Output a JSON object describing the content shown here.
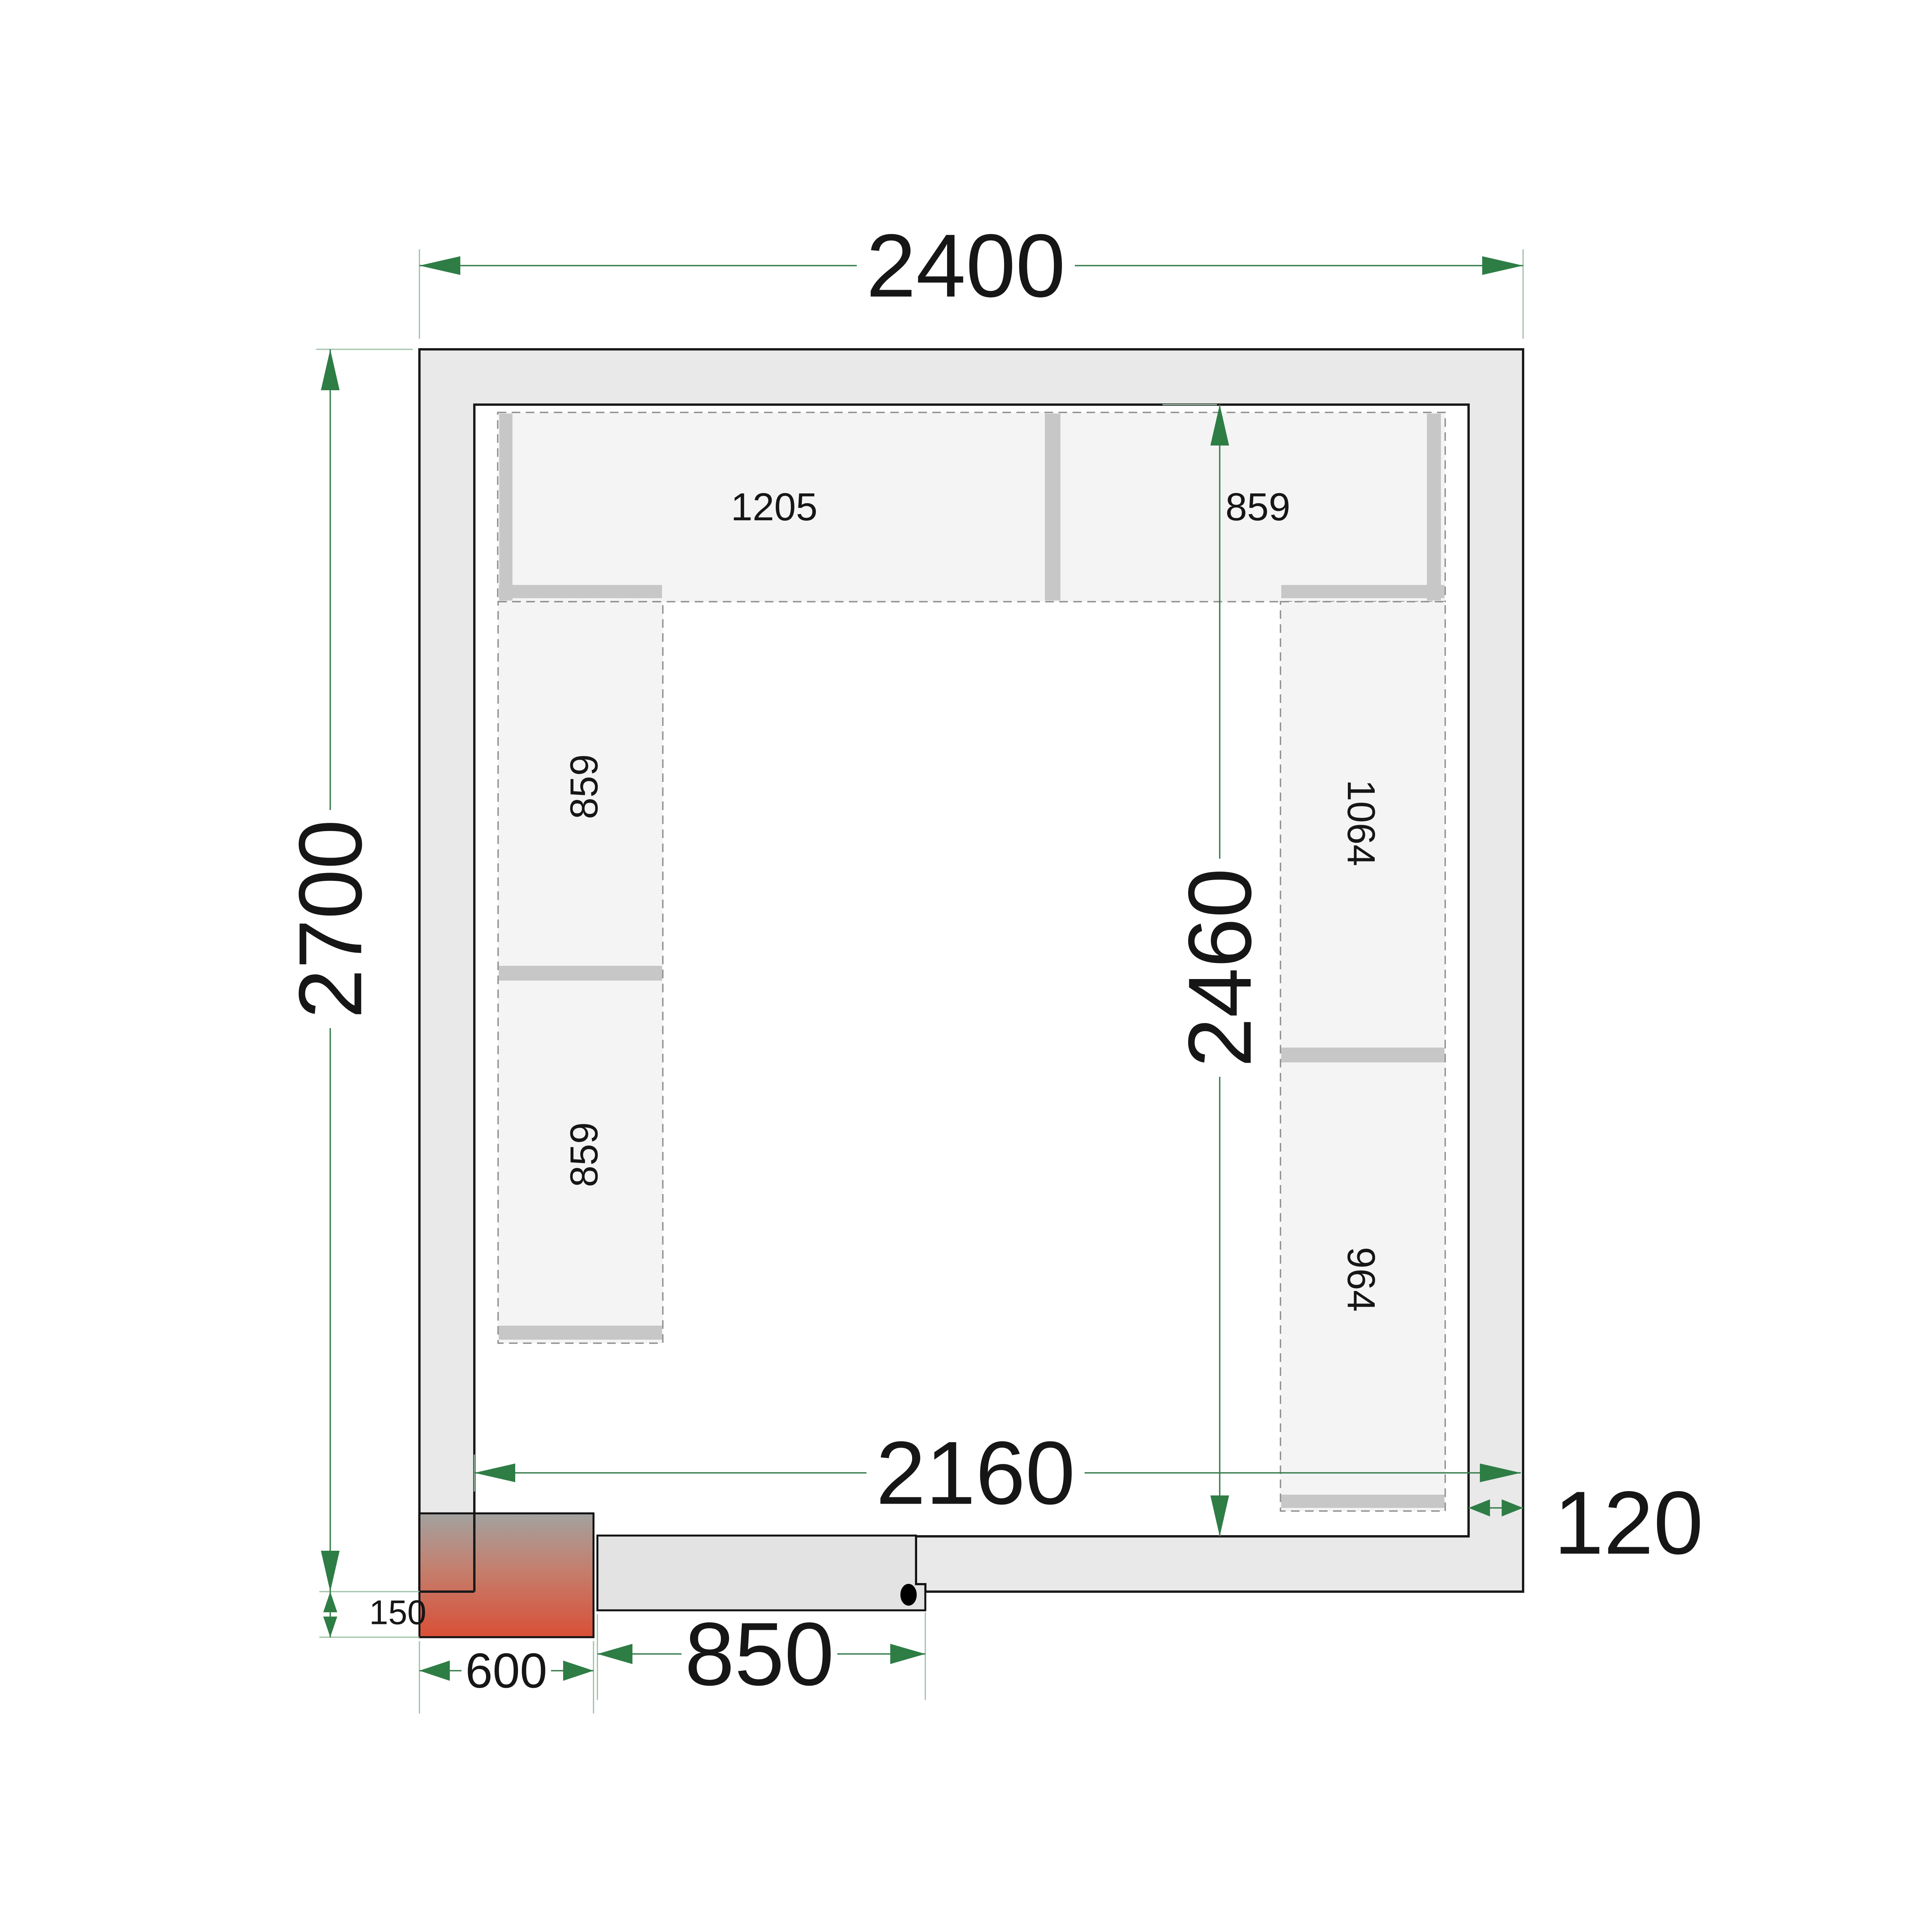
{
  "drawing": {
    "title": "cold-room-floor-plan",
    "dimensions": {
      "outer_width": "2400",
      "outer_height": "2700",
      "inner_width": "2160",
      "inner_height": "2460",
      "wall_thickness": "120",
      "door_width": "850",
      "unit_width": "600",
      "unit_offset": "150"
    },
    "shelves": {
      "top_left": "1205",
      "top_right": "859",
      "left_upper": "859",
      "left_lower": "859",
      "right_upper": "1064",
      "right_lower": "964"
    },
    "colors": {
      "outline": "#1a1a1a",
      "wall_fill": "#e9e9e9",
      "floor": "#ffffff",
      "shelf_fill": "#f4f4f4",
      "shelf_dash": "#8f8f8f",
      "rail": "#c7c7c7",
      "door_fill": "#e3e3e3",
      "dim_line": "#3a7d4e",
      "ext_line": "#9dbfa5",
      "arrow": "#2e7d45",
      "text": "#161616",
      "unit_gradient_top": "#a2a29f",
      "unit_gradient_mid": "#c47f6e",
      "unit_gradient_bottom": "#d94f36"
    }
  }
}
